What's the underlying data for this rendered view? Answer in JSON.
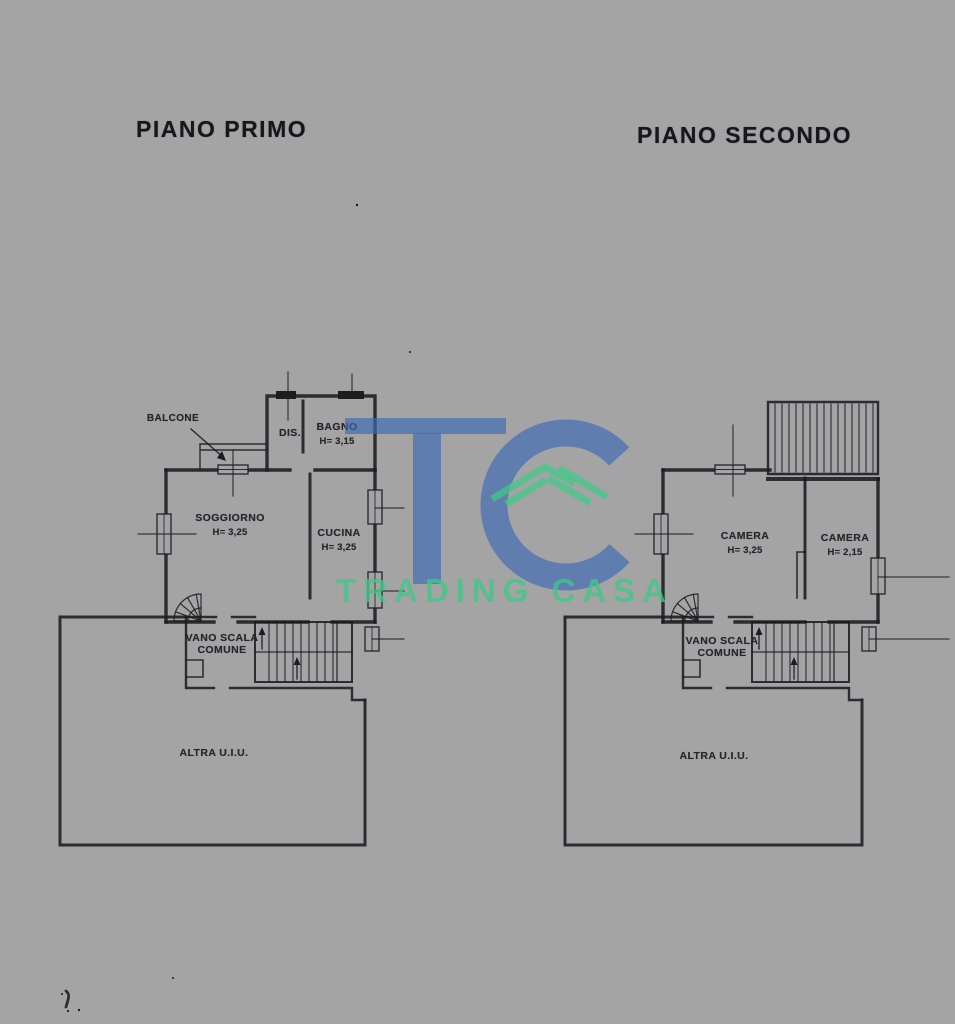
{
  "document": {
    "background_color": "#a5a4a5",
    "ink_color": "#1d1d20"
  },
  "plans": [
    {
      "id": "piano-primo",
      "title": "PIANO PRIMO",
      "rooms": [
        {
          "name": "BALCONE"
        },
        {
          "name": "DIS."
        },
        {
          "name": "BAGNO",
          "height": "H= 3,15"
        },
        {
          "name": "SOGGIORNO",
          "height": "H= 3,25"
        },
        {
          "name": "CUCINA",
          "height": "H= 3,25"
        },
        {
          "name": "VANO SCALA",
          "line2": "COMUNE"
        },
        {
          "name": "ALTRA U.I.U."
        }
      ]
    },
    {
      "id": "piano-secondo",
      "title": "PIANO SECONDO",
      "rooms": [
        {
          "name": "CAMERA",
          "height": "H= 3,25"
        },
        {
          "name": "CAMERA",
          "height": "H= 2,15"
        },
        {
          "name": "VANO SCALA",
          "line2": "COMUNE"
        },
        {
          "name": "ALTRA U.I.U."
        }
      ]
    }
  ],
  "watermark": {
    "initials": "TC",
    "label": "TRADING CASA",
    "blue": "#3d69b6",
    "green": "#3fc987"
  }
}
